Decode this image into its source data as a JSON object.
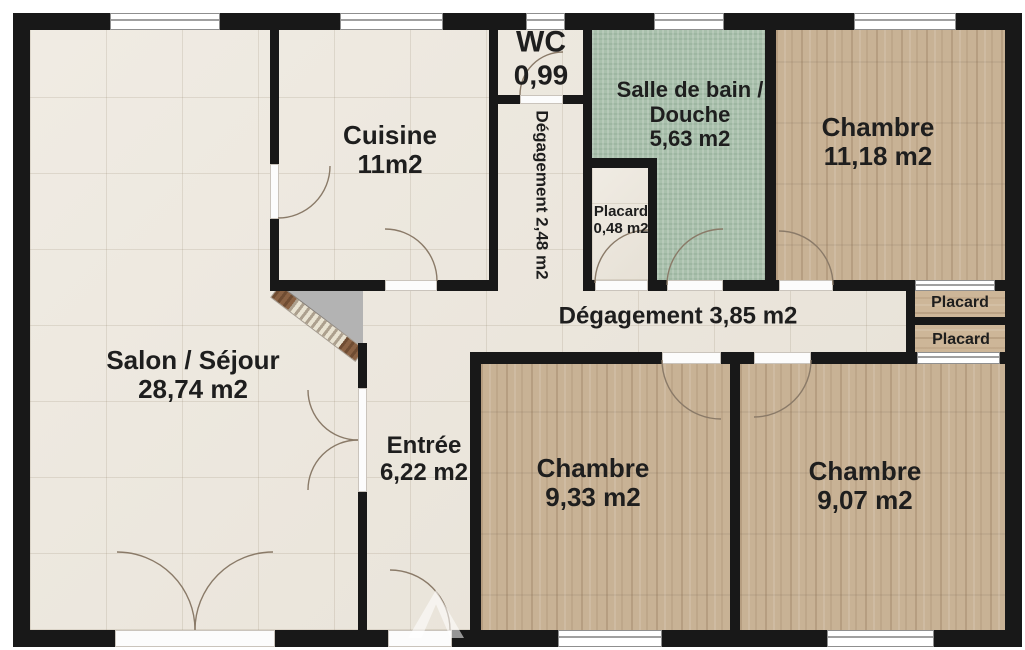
{
  "colors": {
    "wall": "#181818",
    "tile_floor": "#ebe5da",
    "bathroom_floor": "#a9c0ac",
    "wood_floor": "#c8b295",
    "label_text": "#1e1e1e",
    "dead_space_gray": "#b3b3b3"
  },
  "rooms": {
    "salon": {
      "name": "Salon / Séjour",
      "area": "28,74 m2"
    },
    "cuisine": {
      "name": "Cuisine",
      "area": "11m2"
    },
    "wc": {
      "name": "WC",
      "area": "0,99"
    },
    "degagement_couloir": {
      "label": "Dégagement 2,48 m2"
    },
    "salle_de_bain": {
      "name_line1": "Salle de bain /",
      "name_line2": "Douche",
      "area": "5,63 m2"
    },
    "chambre_1": {
      "name": "Chambre",
      "area": "11,18 m2"
    },
    "placard_sdb": {
      "name": "Placard",
      "area": "0,48 m2"
    },
    "degagement_hall": {
      "label": "Dégagement 3,85 m2"
    },
    "placard_haut": {
      "name": "Placard"
    },
    "placard_bas": {
      "name": "Placard"
    },
    "entree": {
      "name": "Entrée",
      "area": "6,22 m2"
    },
    "chambre_2": {
      "name": "Chambre",
      "area": "9,33 m2"
    },
    "chambre_3": {
      "name": "Chambre",
      "area": "9,07 m2"
    }
  }
}
